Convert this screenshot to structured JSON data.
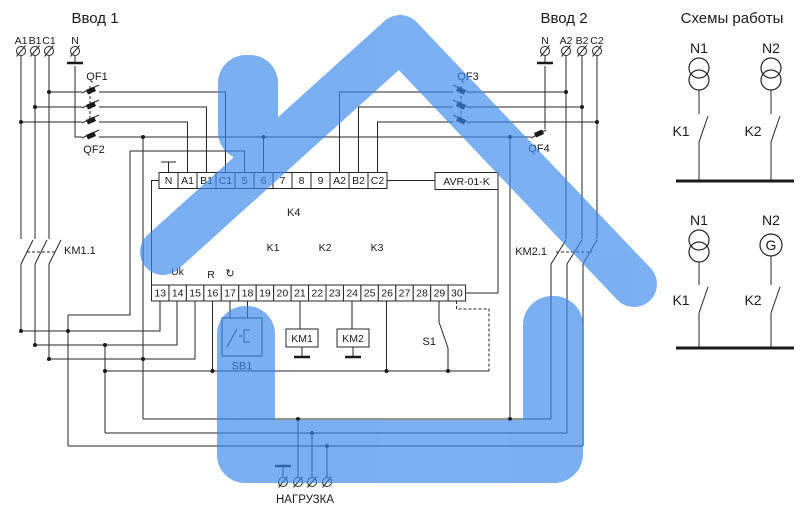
{
  "colors": {
    "watermark": "#3A89EC",
    "line": "#262626",
    "text": "#1a1a1a"
  },
  "input1": {
    "title": "Ввод 1",
    "terminals": [
      "A1",
      "B1",
      "C1",
      "N"
    ]
  },
  "input2": {
    "title": "Ввод 2",
    "terminals": [
      "N",
      "A2",
      "B2",
      "C2"
    ]
  },
  "breakers": {
    "qf1": "QF1",
    "qf2": "QF2",
    "qf3": "QF3",
    "qf4": "QF4"
  },
  "contactor_contacts": {
    "km11": "KM1.1",
    "km21": "KM2.1"
  },
  "device": {
    "model": "AVR-01-K",
    "top_terminals": [
      "N",
      "A1",
      "B1",
      "C1",
      "5",
      "6",
      "7",
      "8",
      "9",
      "A2",
      "B2",
      "C2"
    ],
    "bottom_terminals": [
      "13",
      "14",
      "15",
      "16",
      "17",
      "18",
      "19",
      "20",
      "21",
      "22",
      "23",
      "24",
      "25",
      "26",
      "27",
      "28",
      "29",
      "30"
    ],
    "internal_labels": {
      "k4": "K4",
      "uk": "Uk",
      "r": "R",
      "rotate_icon": "↻",
      "k1": "K1",
      "k2": "K2",
      "k3": "K3"
    }
  },
  "coils": {
    "km1": "KM1",
    "km2": "KM2"
  },
  "controls": {
    "sb1": "SB1",
    "s1": "S1"
  },
  "load": {
    "label": "НАГРУЗКА"
  },
  "schemes": {
    "title": "Схемы работы",
    "scheme1": {
      "source_left": "N1",
      "source_right": "N2",
      "contact_left": "K1",
      "contact_right": "K2"
    },
    "scheme2": {
      "source_left": "N1",
      "source_right": "N2",
      "contact_left": "K1",
      "contact_right": "K2",
      "generator_letter": "G"
    }
  }
}
